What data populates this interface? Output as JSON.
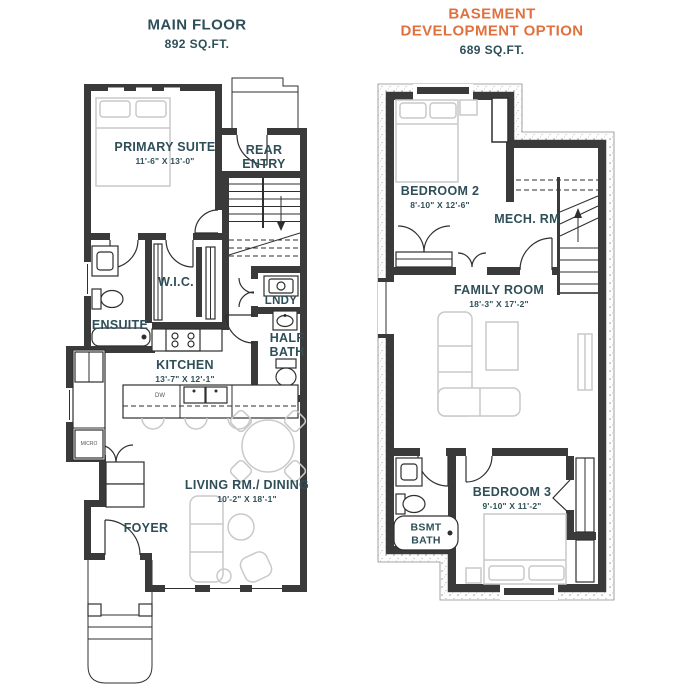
{
  "palette": {
    "teal": "#2E4F58",
    "orange": "#E0713F",
    "wall": "#3A3A3A",
    "furniture": "#C9C9C9"
  },
  "plans": {
    "main_floor": {
      "title": "MAIN FLOOR",
      "area": "892 SQ.FT.",
      "rooms": {
        "primary_suite": {
          "label": "PRIMARY SUITE",
          "dims": "11'-6\" X 13'-0\""
        },
        "rear_entry": {
          "label": "REAR ENTRY"
        },
        "wic": {
          "label": "W.I.C."
        },
        "ensuite": {
          "label": "ENSUITE"
        },
        "laundry": {
          "label": "LNDY"
        },
        "half_bath": {
          "label": "HALF BATH"
        },
        "kitchen": {
          "label": "KITCHEN",
          "dims": "13'-7\" X 12'-1\""
        },
        "living_dining": {
          "label": "LIVING RM./ DINING",
          "dims": "10'-2\" X 18'-1\""
        },
        "foyer": {
          "label": "FOYER"
        }
      },
      "appliances": {
        "dishwasher": "DW",
        "microwave": "MICRO"
      }
    },
    "basement": {
      "title_line1": "BASEMENT",
      "title_line2": "DEVELOPMENT OPTION",
      "area": "689 SQ.FT.",
      "rooms": {
        "bedroom2": {
          "label": "BEDROOM 2",
          "dims": "8'-10\" X 12'-6\""
        },
        "mech": {
          "label": "MECH. RM"
        },
        "family": {
          "label": "FAMILY ROOM",
          "dims": "18'-3\" X 17'-2\""
        },
        "bedroom3": {
          "label": "BEDROOM 3",
          "dims": "9'-10\" X 11'-2\""
        },
        "bsmt_bath": {
          "label": "BSMT BATH"
        }
      }
    }
  }
}
